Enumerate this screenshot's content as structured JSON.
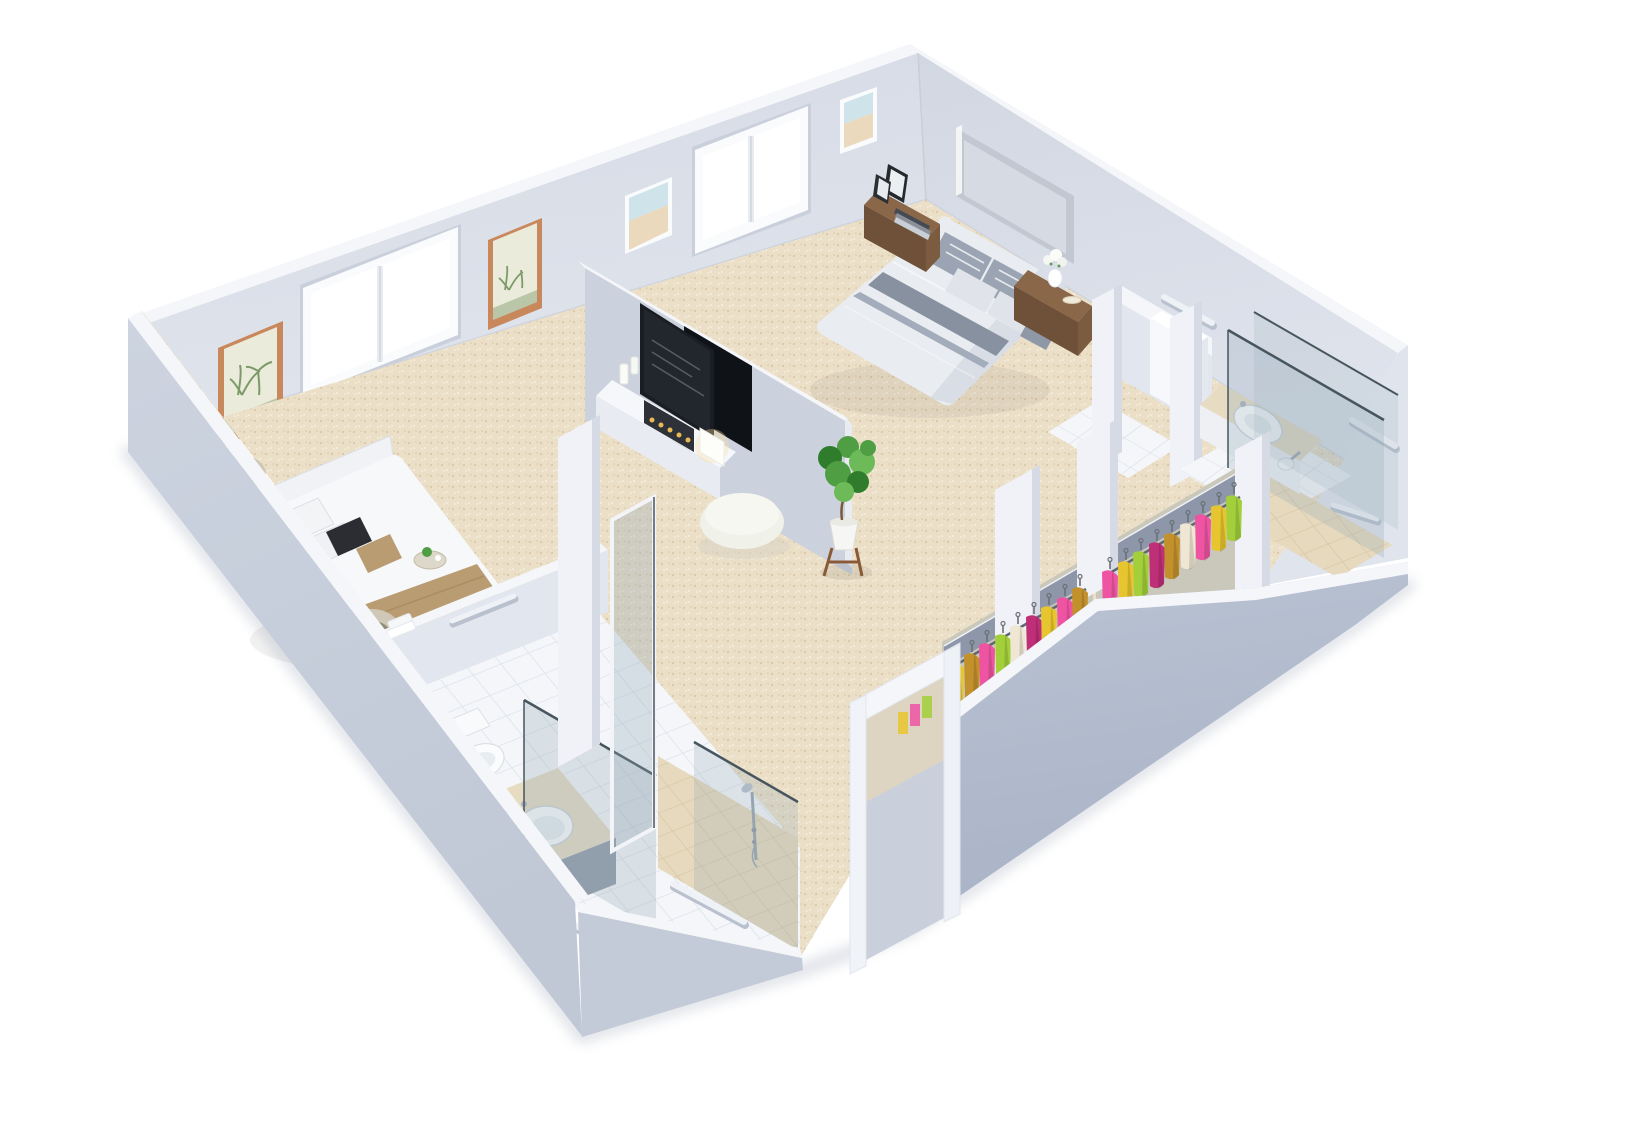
{
  "scene": {
    "type": "3d-floor-plan-cutaway-render",
    "background": "white",
    "rooms": [
      {
        "id": "master-bedroom",
        "position": "upper-right",
        "items": [
          "double-bed",
          "grey-upholstered-headboard",
          "striped-grey-bedding",
          "wooden-nightstand-with-photo-frames-and-books",
          "wooden-nightstand-with-vase-and-plate"
        ]
      },
      {
        "id": "second-bedroom",
        "position": "left",
        "items": [
          "double-bed-white-duvet",
          "tan-bed-runner",
          "black-accent-pillow",
          "tan-accent-pillow",
          "drum-shade-table-lamp",
          "drum-shade-table-lamp",
          "white-nightstand",
          "breakfast-tray"
        ]
      },
      {
        "id": "media-lounge",
        "position": "center",
        "items": [
          "half-height-tv-wall",
          "back-to-back-flatscreen-tvs",
          "white-media-console",
          "candle-fireplace-insert",
          "pillar-candles",
          "cube-table-lamp",
          "round-white-pouf",
          "potted-plant-on-wood-stand"
        ]
      },
      {
        "id": "bathroom-front-left",
        "position": "lower-left",
        "items": [
          "toilet",
          "round-vanity-sink",
          "beige-vanity-counter",
          "glass-shower-screens",
          "chrome-shower-fixture",
          "grab-bars",
          "towels",
          "white-tiled-floor",
          "beige-shower-floor"
        ]
      },
      {
        "id": "bathroom-right",
        "position": "right",
        "items": [
          "oval-vanity-sink",
          "beige-counter",
          "glass-shower-enclosure",
          "shower-head",
          "grab-bars",
          "tiled-floor",
          "beige-shower-floor"
        ]
      },
      {
        "id": "water-closet",
        "position": "upper-center-right",
        "items": [
          "white-partition-walls",
          "tall-white-cabinet",
          "tiled-floor",
          "grab-bars"
        ]
      },
      {
        "id": "walk-in-closets",
        "position": "lower-right",
        "items": [
          "hanging-rail-with-colorful-garments",
          "hanging-rail-with-colorful-garments",
          "overhead-grey-shelf",
          "white-divider-partitions"
        ]
      }
    ],
    "architecture": {
      "windows": [
        {
          "wall": "back-left",
          "panes": 2
        },
        {
          "wall": "back-left",
          "panes": 2
        }
      ],
      "wall_art": [
        {
          "wall": "back-left",
          "style": "palm-print-wood-frame"
        },
        {
          "wall": "back-left",
          "style": "palm-print-wood-frame"
        },
        {
          "wall": "back-left",
          "style": "beach-photo-white-frame"
        },
        {
          "wall": "back-left",
          "style": "beach-photo-white-frame-near-corner"
        }
      ],
      "doorway": {
        "wall": "front-right",
        "state": "open"
      },
      "grab_bar_count": 10
    }
  },
  "palette": {
    "bg": "#ffffff",
    "carpet": "#ebdfc8",
    "carpet_dot": "#d9c9a6",
    "carpet_dot2": "#f6efdf",
    "tile": "#f4f6f9",
    "grout": "#dde2ea",
    "beige_floor": "#e6d9bd",
    "beige_grout": "#d4c5a4",
    "wall_top": "#f4f6fa",
    "wall_face": "#d9dde8",
    "wall_face_light": "#e2e6ee",
    "ext_front_left": "#c9d0dd",
    "ext_front_right": "#b3bccd",
    "ext_bath": "#c3cad8",
    "partition_light": "#f0f2f7",
    "partition_shade": "#d5dae4",
    "tv_wall": "#cbd1dd",
    "headboard": "#c2c8d2",
    "headboard_panel": "#d6dae2",
    "duvet": "#e9ecf1",
    "duvet_shade": "#d3d8e0",
    "stripe_dark": "#87919f",
    "stripe_mid": "#a3acba",
    "pillow_light": "#e0e4ea",
    "pillow_striped": "#9aa4b2",
    "pillow_black": "#2c2d33",
    "tan": "#ba9c72",
    "tan_dark": "#a2845c",
    "wood_top": "#8a6749",
    "wood_front": "#6e5138",
    "wood_side": "#7c5c40",
    "lamp_shade": "#cfc8b6",
    "lamp_inner": "#948d7c",
    "tv_frame": "#1a1e24",
    "tv_back": "#0f1217",
    "console": "#f5f7fa",
    "console_front": "#e8ebf1",
    "insert": "#2e3138",
    "candle_amber": "#e9b954",
    "pouf": "#f0f1e9",
    "pouf_top": "#f6f7f1",
    "plant_dark": "#2f7d2c",
    "plant_mid": "#4f9e43",
    "plant_light": "#6dbb58",
    "pot": "#f6f7f4",
    "stand_wood": "#8a5a36",
    "glass": "#90a7b4",
    "glass_edge": "#47555f",
    "chrome": "#9aa5b1",
    "counter": "#e7dcc2",
    "cabinet": "#929baa",
    "cabinet_side": "#a8b0bd",
    "porcelain": "#fbfcfd",
    "porcelain_shade": "#e8edf1",
    "frame_wood": "#c8885c",
    "art_paper": "#ebebdb",
    "palm_green": "#7c9a68",
    "art_sky": "#cfe3ea",
    "art_sand": "#ead9bc",
    "frame_white": "#fafbfc",
    "shelf": "#8d97a9",
    "rail": "#5f6871",
    "garment_yellow": "#e7c52e",
    "garment_olive": "#c3912c",
    "garment_pink": "#ee54a2",
    "garment_green": "#a2cf3a",
    "garment_cream": "#efe7d4",
    "garment_magenta": "#bf2f78",
    "grab_bar": "#eef1f6",
    "grab_bar_shadow": "#b9c1cf",
    "shadow": "#b9c0cc"
  }
}
